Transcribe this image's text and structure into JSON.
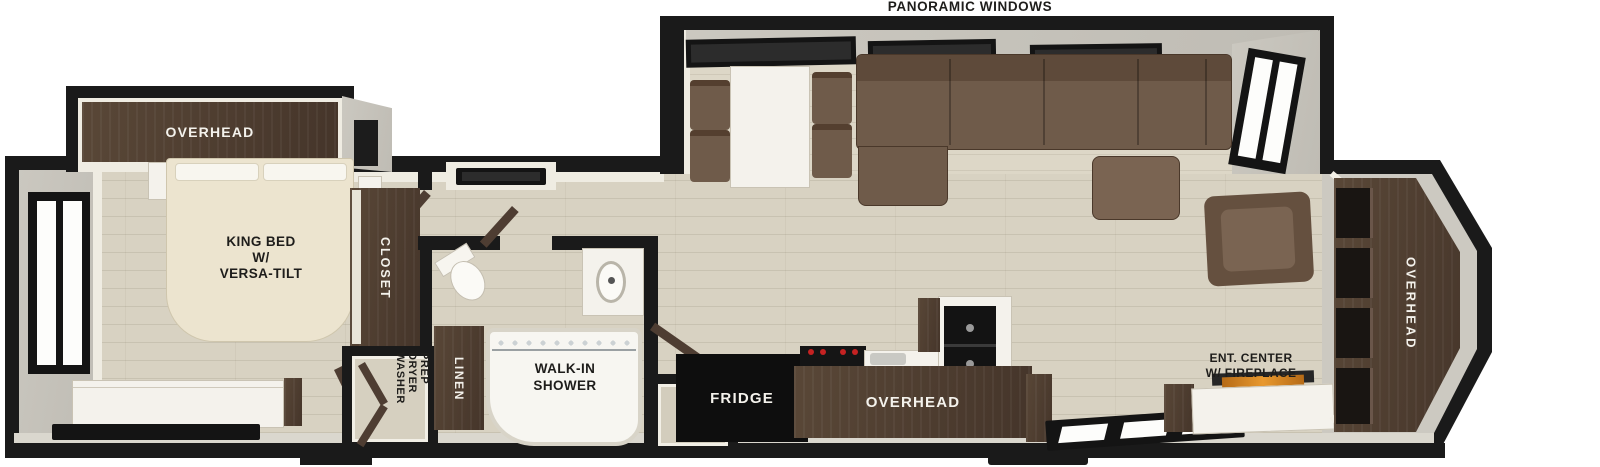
{
  "callouts": {
    "panoramic_windows": "PANORAMIC WINDOWS"
  },
  "bedroom": {
    "overhead": "OVERHEAD",
    "bed_lines": [
      "KING BED",
      "W/",
      "VERSA-TILT"
    ],
    "closet": "CLOSET",
    "laundry_lines": [
      "WASHER",
      "DRYER",
      "PREP"
    ]
  },
  "bathroom": {
    "linen": "LINEN",
    "shower_lines": [
      "WALK-IN",
      "SHOWER"
    ]
  },
  "kitchen": {
    "fridge": "FRIDGE",
    "overhead": "OVERHEAD"
  },
  "living": {
    "ent_center_lines": [
      "ENT. CENTER",
      "W/ FIREPLACE"
    ],
    "rear_overhead": "OVERHEAD"
  },
  "colors": {
    "wall": "#1a1a1a",
    "floor": "#d8d2c2",
    "cabinet_wood": "#4e3d31",
    "sofa": "#6f5b4a",
    "bed": "#ece4cf",
    "counter": "#f4f2ec",
    "fireplace_glow": "#e08a28"
  }
}
